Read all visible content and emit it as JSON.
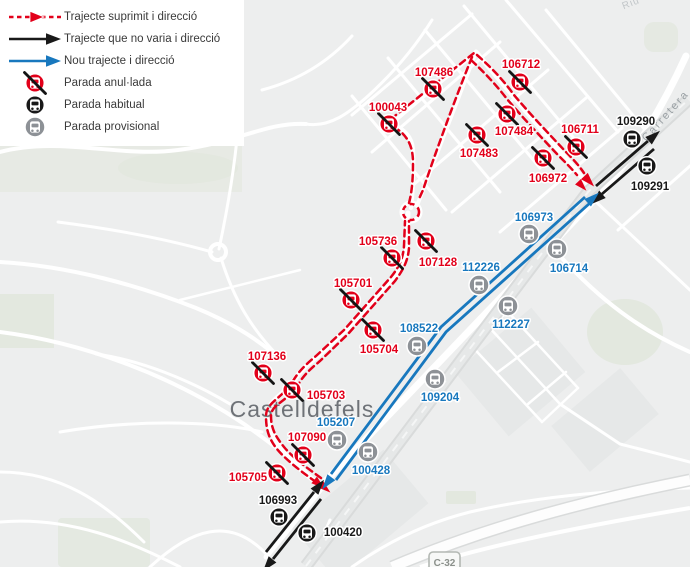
{
  "legend": {
    "items": [
      {
        "symbol": "route-suppressed",
        "label": "Trajecte suprimit i direcció"
      },
      {
        "symbol": "route-unchanged",
        "label": "Trajecte que no varia i direcció"
      },
      {
        "symbol": "route-new",
        "label": "Nou trajecte i direcció"
      },
      {
        "symbol": "stop-cancelled",
        "label": "Parada anul·lada"
      },
      {
        "symbol": "stop-regular",
        "label": "Parada habitual"
      },
      {
        "symbol": "stop-provisional",
        "label": "Parada provisional"
      }
    ]
  },
  "map": {
    "city_label": "Castelldefels",
    "road_labels": [
      {
        "text": "Carretera",
        "x": 668,
        "y": 118,
        "rotate": -48
      },
      {
        "text": "Riu",
        "x": 632,
        "y": 6,
        "rotate": -22
      }
    ],
    "shield": {
      "text": "C-32"
    },
    "stops": [
      {
        "id": "107486",
        "kind": "cancelled",
        "x": 433,
        "y": 89,
        "lx": 434,
        "ly": 72
      },
      {
        "id": "106712",
        "kind": "cancelled",
        "x": 520,
        "y": 82,
        "lx": 521,
        "ly": 64
      },
      {
        "id": "100043",
        "kind": "cancelled",
        "x": 389,
        "y": 124,
        "lx": 388,
        "ly": 107
      },
      {
        "id": "107484",
        "kind": "cancelled",
        "x": 507,
        "y": 114,
        "lx": 514,
        "ly": 131
      },
      {
        "id": "106711",
        "kind": "cancelled",
        "x": 576,
        "y": 147,
        "lx": 580,
        "ly": 129
      },
      {
        "id": "107483",
        "kind": "cancelled",
        "x": 477,
        "y": 135,
        "lx": 479,
        "ly": 153
      },
      {
        "id": "106972",
        "kind": "cancelled",
        "x": 543,
        "y": 158,
        "lx": 548,
        "ly": 178
      },
      {
        "id": "105736",
        "kind": "cancelled",
        "x": 392,
        "y": 258,
        "lx": 378,
        "ly": 241
      },
      {
        "id": "107128",
        "kind": "cancelled",
        "x": 426,
        "y": 241,
        "lx": 438,
        "ly": 262
      },
      {
        "id": "105701",
        "kind": "cancelled",
        "x": 351,
        "y": 300,
        "lx": 353,
        "ly": 283
      },
      {
        "id": "105704",
        "kind": "cancelled",
        "x": 373,
        "y": 330,
        "lx": 379,
        "ly": 349
      },
      {
        "id": "107136",
        "kind": "cancelled",
        "x": 263,
        "y": 373,
        "lx": 267,
        "ly": 356
      },
      {
        "id": "105703",
        "kind": "cancelled",
        "x": 292,
        "y": 390,
        "lx": 326,
        "ly": 395
      },
      {
        "id": "107090",
        "kind": "cancelled",
        "x": 303,
        "y": 455,
        "lx": 307,
        "ly": 437
      },
      {
        "id": "105705",
        "kind": "cancelled",
        "x": 277,
        "y": 473,
        "lx": 248,
        "ly": 477
      },
      {
        "id": "109290",
        "kind": "regular",
        "x": 632,
        "y": 139,
        "lx": 636,
        "ly": 121
      },
      {
        "id": "109291",
        "kind": "regular",
        "x": 647,
        "y": 166,
        "lx": 650,
        "ly": 186
      },
      {
        "id": "106993",
        "kind": "regular",
        "x": 279,
        "y": 517,
        "lx": 278,
        "ly": 500
      },
      {
        "id": "100420",
        "kind": "regular",
        "x": 307,
        "y": 533,
        "lx": 343,
        "ly": 532
      },
      {
        "id": "106973",
        "kind": "provisional",
        "x": 529,
        "y": 234,
        "lx": 534,
        "ly": 217
      },
      {
        "id": "106714",
        "kind": "provisional",
        "x": 557,
        "y": 249,
        "lx": 569,
        "ly": 268
      },
      {
        "id": "112226",
        "kind": "provisional",
        "x": 479,
        "y": 285,
        "lx": 481,
        "ly": 267
      },
      {
        "id": "112227",
        "kind": "provisional",
        "x": 508,
        "y": 306,
        "lx": 511,
        "ly": 324
      },
      {
        "id": "108522",
        "kind": "provisional",
        "x": 417,
        "y": 346,
        "lx": 419,
        "ly": 328
      },
      {
        "id": "109204",
        "kind": "provisional",
        "x": 435,
        "y": 379,
        "lx": 440,
        "ly": 397
      },
      {
        "id": "105207",
        "kind": "provisional",
        "x": 337,
        "y": 440,
        "lx": 336,
        "ly": 422
      },
      {
        "id": "100428",
        "kind": "provisional",
        "x": 368,
        "y": 452,
        "lx": 371,
        "ly": 470
      }
    ]
  },
  "colors": {
    "suppressed": "#e2001a",
    "unchanged": "#191919",
    "new": "#1878be",
    "provisional_icon": "#8d9196",
    "label_blue": "#1878be"
  }
}
